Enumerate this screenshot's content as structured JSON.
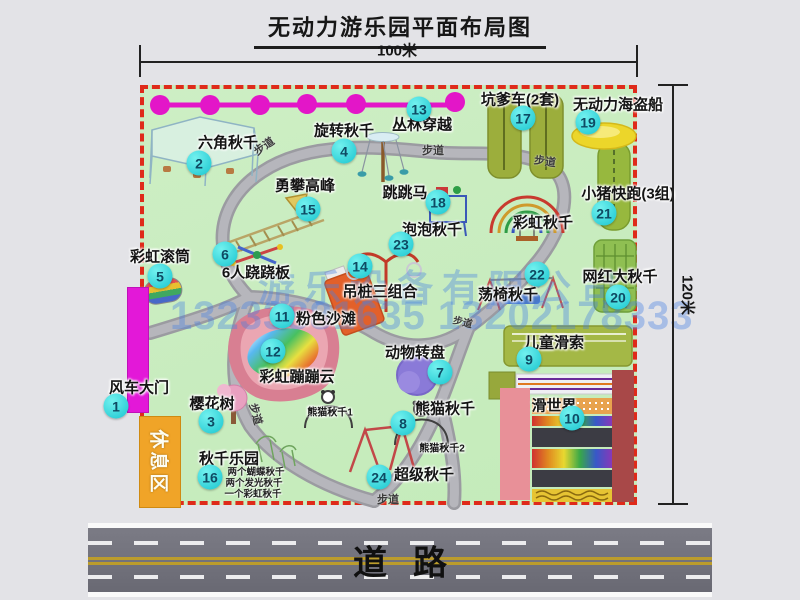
{
  "title": "无动力游乐园平面布局图",
  "dimensions": {
    "width": "100米",
    "height": "120米"
  },
  "road": {
    "label": "道路"
  },
  "rest_area": "休息区",
  "path_label": "步道",
  "watermark": {
    "company": "游乐设备有限公司",
    "phone": "13233881635 13202178333"
  },
  "features": [
    {
      "num": "1",
      "name": "风车大门"
    },
    {
      "num": "2",
      "name": "六角秋千"
    },
    {
      "num": "3",
      "name": "樱花树"
    },
    {
      "num": "4",
      "name": "旋转秋千"
    },
    {
      "num": "5",
      "name": "彩虹滚筒"
    },
    {
      "num": "6",
      "name": "6人跷跷板"
    },
    {
      "num": "7",
      "name": "动物转盘"
    },
    {
      "num": "8",
      "name": "熊猫秋千"
    },
    {
      "num": "9",
      "name": "儿童滑索"
    },
    {
      "num": "10",
      "name": "滑世界"
    },
    {
      "num": "11",
      "name": "粉色沙滩"
    },
    {
      "num": "12",
      "name": "彩虹蹦蹦云"
    },
    {
      "num": "13",
      "name": "丛林穿越"
    },
    {
      "num": "14",
      "name": "吊桩三组合"
    },
    {
      "num": "15",
      "name": "勇攀高峰"
    },
    {
      "num": "16",
      "name": "秋千乐园"
    },
    {
      "num": "17",
      "name": "坑爹车(2套)"
    },
    {
      "num": "18",
      "name": "跳跳马"
    },
    {
      "num": "19",
      "name": "无动力海盗船"
    },
    {
      "num": "20",
      "name": "网红大秋千"
    },
    {
      "num": "21",
      "name": "小猪快跑(3组)"
    },
    {
      "num": "22",
      "name": "荡椅秋千"
    },
    {
      "num": "23",
      "name": "泡泡秋千"
    },
    {
      "num": "24",
      "name": "超级秋千"
    }
  ],
  "annotations": {
    "rainbow_swing": "彩虹秋千",
    "panda_swing_1": "熊猫秋千1",
    "panda_swing_2": "熊猫秋千2",
    "swing_notes": [
      "两个蝴蝶秋千",
      "两个发光秋千",
      "一个彩虹秋千"
    ]
  },
  "colors": {
    "park": "#c9ecc0",
    "border": "#df2a1a",
    "badge": "#2fd9dd",
    "gate": "#e318d8",
    "road": "#70707a"
  }
}
